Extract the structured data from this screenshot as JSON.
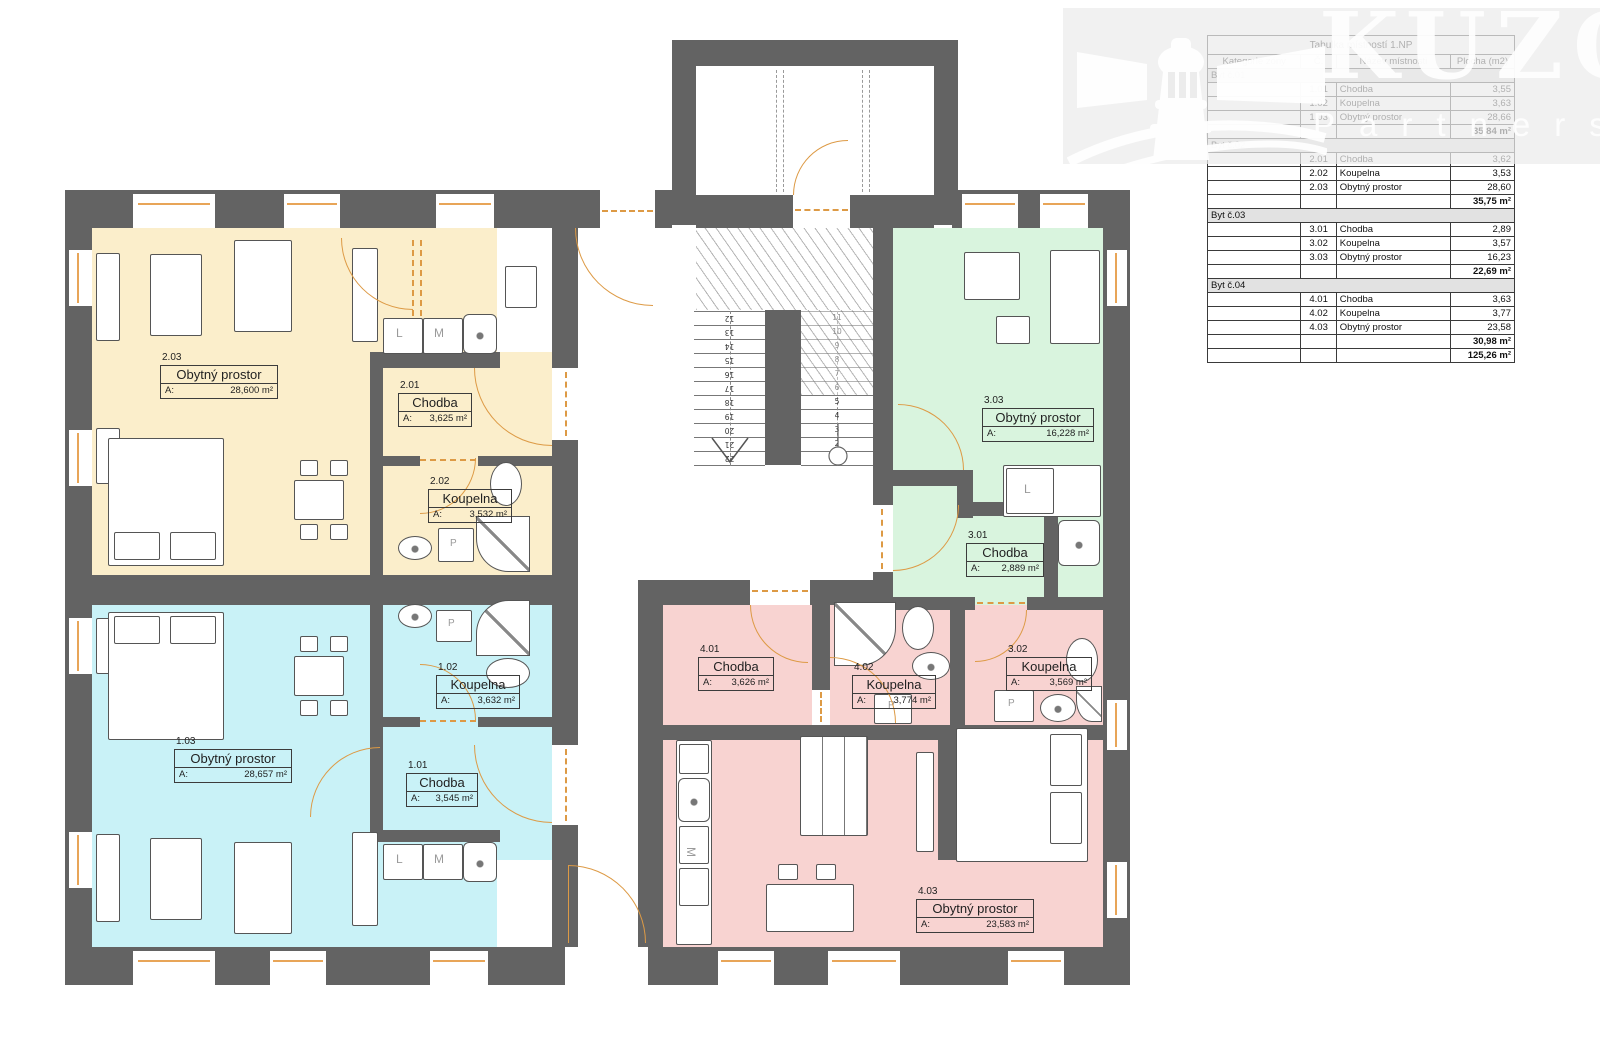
{
  "watermark": {
    "brand": "KUZO",
    "brand_sub": "Partners"
  },
  "table": {
    "title": "Tabulka místností 1.NP",
    "headers": [
      "Kategorie zóny",
      "Č.",
      "Název místnosti",
      "Plocha (m2)"
    ],
    "groups": [
      {
        "category": "Byt č.01",
        "rows": [
          [
            "1.01",
            "Chodba",
            "3,55"
          ],
          [
            "1.02",
            "Koupelna",
            "3,63"
          ],
          [
            "1.03",
            "Obytný prostor",
            "28,66"
          ]
        ],
        "subtotal": "35,84 m²"
      },
      {
        "category": "Byt č.02",
        "rows": [
          [
            "2.01",
            "Chodba",
            "3,62"
          ],
          [
            "2.02",
            "Koupelna",
            "3,53"
          ],
          [
            "2.03",
            "Obytný prostor",
            "28,60"
          ]
        ],
        "subtotal": "35,75 m²"
      },
      {
        "category": "Byt č.03",
        "rows": [
          [
            "3.01",
            "Chodba",
            "2,89"
          ],
          [
            "3.02",
            "Koupelna",
            "3,57"
          ],
          [
            "3.03",
            "Obytný prostor",
            "16,23"
          ]
        ],
        "subtotal": "22,69 m²"
      },
      {
        "category": "Byt č.04",
        "rows": [
          [
            "4.01",
            "Chodba",
            "3,63"
          ],
          [
            "4.02",
            "Koupelna",
            "3,77"
          ],
          [
            "4.03",
            "Obytný prostor",
            "23,58"
          ]
        ],
        "subtotal": "30,98 m²"
      }
    ],
    "grand_total": "125,26 m²"
  },
  "rooms": [
    {
      "code": "2.03",
      "name": "Obytný prostor",
      "area_label": "A:",
      "area_value": "28,600 m²"
    },
    {
      "code": "2.01",
      "name": "Chodba",
      "area_label": "A:",
      "area_value": "3,625 m²"
    },
    {
      "code": "2.02",
      "name": "Koupelna",
      "area_label": "A:",
      "area_value": "3,532 m²"
    },
    {
      "code": "3.03",
      "name": "Obytný prostor",
      "area_label": "A:",
      "area_value": "16,228 m²"
    },
    {
      "code": "3.01",
      "name": "Chodba",
      "area_label": "A:",
      "area_value": "2,889 m²"
    },
    {
      "code": "3.02",
      "name": "Koupelna",
      "area_label": "A:",
      "area_value": "3,569 m²"
    },
    {
      "code": "1.03",
      "name": "Obytný prostor",
      "area_label": "A:",
      "area_value": "28,657 m²"
    },
    {
      "code": "1.02",
      "name": "Koupelna",
      "area_label": "A:",
      "area_value": "3,632 m²"
    },
    {
      "code": "1.01",
      "name": "Chodba",
      "area_label": "A:",
      "area_value": "3,545 m²"
    },
    {
      "code": "4.01",
      "name": "Chodba",
      "area_label": "A:",
      "area_value": "3,626 m²"
    },
    {
      "code": "4.02",
      "name": "Koupelna",
      "area_label": "A:",
      "area_value": "3,774 m²"
    },
    {
      "code": "4.03",
      "name": "Obytný prostor",
      "area_label": "A:",
      "area_value": "23,583 m²"
    }
  ],
  "stairs": {
    "left": [
      "12",
      "13",
      "14",
      "15",
      "16",
      "17",
      "18",
      "19",
      "20",
      "21",
      "22"
    ],
    "right": [
      "11",
      "10",
      "9",
      "8",
      "7",
      "6",
      "5",
      "4",
      "3",
      "2",
      "1"
    ]
  },
  "appliances": {
    "letter_l": "L",
    "letter_m": "M",
    "letter_p": "P"
  },
  "colors": {
    "wall": "#636363",
    "byt1": "#c9f2f7",
    "byt2": "#fbeecb",
    "byt3": "#d9f4de",
    "byt4": "#f8d3d1",
    "door": "#dd9a45"
  }
}
